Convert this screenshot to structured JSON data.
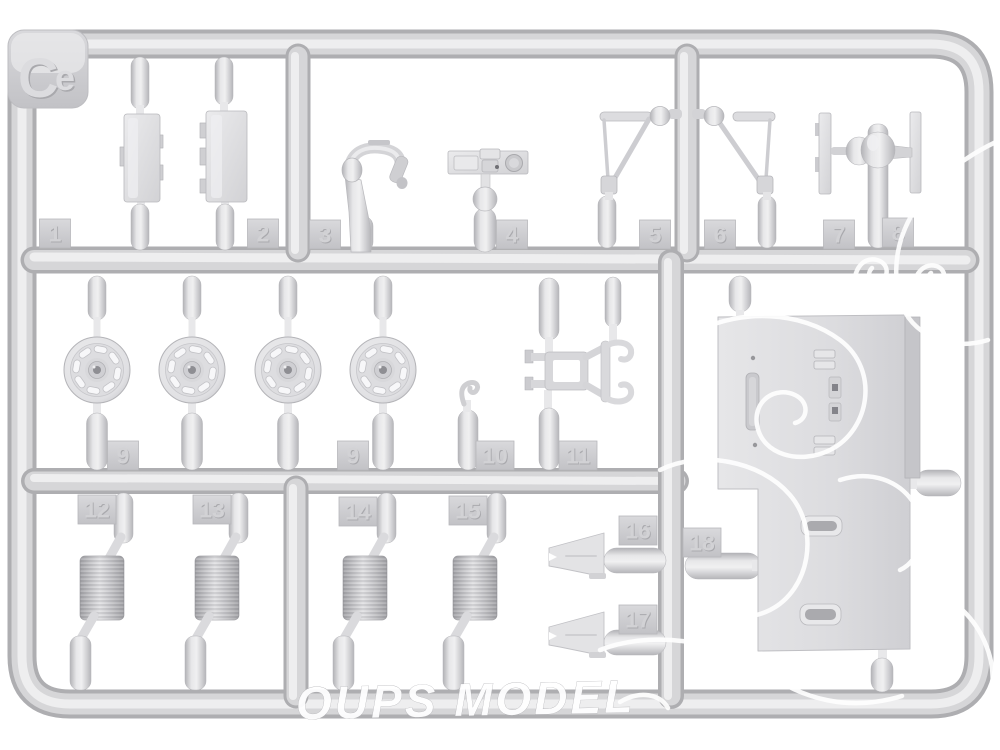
{
  "photo": {
    "subject": "plastic model kit sprue photograph",
    "gate_label": "Ce",
    "part_tabs": [
      "1",
      "2",
      "3",
      "4",
      "5",
      "6",
      "7",
      "8",
      "9",
      "9",
      "10",
      "11",
      "12",
      "13",
      "14",
      "15",
      "16",
      "17",
      "18"
    ],
    "watermark_text": "OUPS MODEL",
    "colors": {
      "background": "#ffffff",
      "plastic_mid": "#d6d6d8",
      "plastic_edge": "#aeaeb1",
      "plastic_highlight": "#eeeeef",
      "tab_face": "#cdcdd0",
      "watermark": "#ffffff"
    }
  }
}
